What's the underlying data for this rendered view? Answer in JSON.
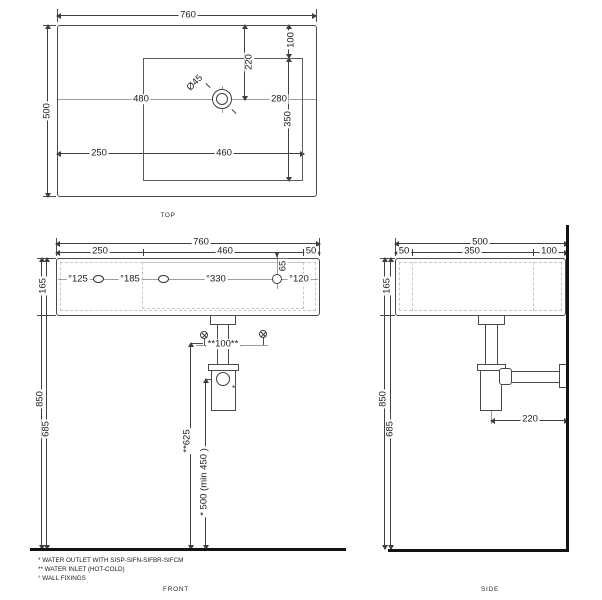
{
  "drawing": {
    "top_view": {
      "label": "TOP",
      "overall_width": "760",
      "overall_depth": "500",
      "left_to_bowl": "250",
      "bowl_width": "460",
      "left_to_drain": "480",
      "drain_to_right": "280",
      "top_to_bowl": "100",
      "top_to_drain": "220",
      "bowl_depth": "350",
      "drain_diameter": "Ø45"
    },
    "front_view": {
      "label": "FRONT",
      "overall_width": "760",
      "seg_left": "250",
      "seg_center": "460",
      "seg_right": "50",
      "height": "165",
      "height_floor_to_top": "850",
      "height_floor_to_bottom": "685",
      "fixing_1": "°125",
      "fixing_2": "°185",
      "fixing_3": "°330",
      "fixing_4": "°120",
      "fixing_depth": "65",
      "inlet_spacing": "**100**",
      "inlet_height": "**625",
      "outlet_height": "* 500 (min 450 )",
      "trap_mark": "*"
    },
    "side_view": {
      "label": "SIDE",
      "overall_depth": "500",
      "seg_front": "50",
      "seg_middle": "350",
      "seg_back": "100",
      "height": "165",
      "height_floor_to_top": "850",
      "height_floor_to_bottom": "685",
      "trap_to_wall": "220"
    },
    "notes": {
      "outlet": "* WATER OUTLET WITH SISP-SIFN-SIFBR-SIFCM",
      "inlet": "** WATER INLET  (HOT-COLD)",
      "fixings": "° WALL FIXINGS"
    }
  }
}
